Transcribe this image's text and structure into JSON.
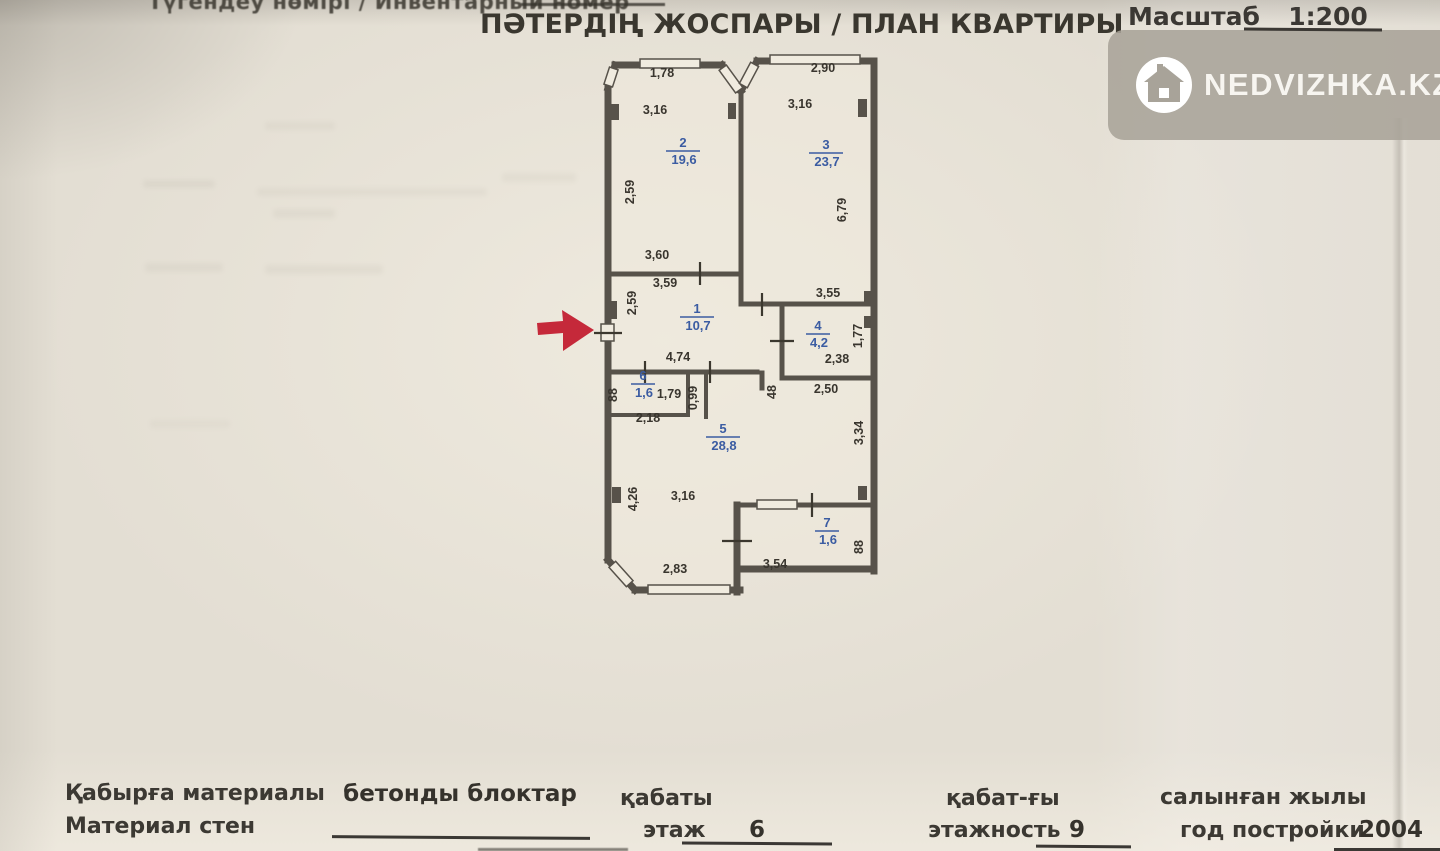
{
  "document": {
    "inventory_label": "Түгендеу нөмірі / Инвентарный номер",
    "title": "ПӘТЕРДІҢ ЖОСПАРЫ / ПЛАН КВАРТИРЫ",
    "scale_label": "Масштаб",
    "scale_value": "1:200"
  },
  "watermark": {
    "brand": "NEDVIZHKA.KZ",
    "icon": "house-icon",
    "badge_color": "#a8a399"
  },
  "plan": {
    "colors": {
      "wall": "#57524a",
      "dimension_text": "#39352e",
      "room_label": "#3b5ca2",
      "arrow": "#c5293a"
    },
    "rooms": [
      {
        "number": "1",
        "area": "10,7",
        "x": 697,
        "y": 317
      },
      {
        "number": "2",
        "area": "19,6",
        "x": 683,
        "y": 151
      },
      {
        "number": "3",
        "area": "23,7",
        "x": 826,
        "y": 153
      },
      {
        "number": "4",
        "area": "4,2",
        "x": 818,
        "y": 334
      },
      {
        "number": "5",
        "area": "28,8",
        "x": 723,
        "y": 437
      },
      {
        "number": "6",
        "area": "1,6",
        "x": 643,
        "y": 384
      },
      {
        "number": "7",
        "area": "1,6",
        "x": 827,
        "y": 531
      }
    ],
    "dimensions": [
      {
        "text": "1,78",
        "x": 662,
        "y": 77,
        "rot": 0
      },
      {
        "text": "2,90",
        "x": 823,
        "y": 72,
        "rot": 0
      },
      {
        "text": "3,16",
        "x": 655,
        "y": 114,
        "rot": 0
      },
      {
        "text": "3,16",
        "x": 800,
        "y": 108,
        "rot": 0
      },
      {
        "text": "2,59",
        "x": 634,
        "y": 192,
        "rot": -90
      },
      {
        "text": "6,79",
        "x": 846,
        "y": 210,
        "rot": -90
      },
      {
        "text": "3,60",
        "x": 657,
        "y": 259,
        "rot": 0
      },
      {
        "text": "3,59",
        "x": 665,
        "y": 287,
        "rot": 0
      },
      {
        "text": "2,59",
        "x": 636,
        "y": 303,
        "rot": -90
      },
      {
        "text": "3,55",
        "x": 828,
        "y": 297,
        "rot": 0
      },
      {
        "text": "1,77",
        "x": 862,
        "y": 336,
        "rot": -90
      },
      {
        "text": "2,38",
        "x": 837,
        "y": 363,
        "rot": 0
      },
      {
        "text": "4,74",
        "x": 678,
        "y": 361,
        "rot": 0
      },
      {
        "text": "1,79",
        "x": 669,
        "y": 398,
        "rot": 0
      },
      {
        "text": "88",
        "x": 617,
        "y": 395,
        "rot": -90
      },
      {
        "text": "0,99",
        "x": 697,
        "y": 398,
        "rot": -90
      },
      {
        "text": "48",
        "x": 776,
        "y": 392,
        "rot": -90
      },
      {
        "text": "2,50",
        "x": 826,
        "y": 393,
        "rot": 0
      },
      {
        "text": "2,18",
        "x": 648,
        "y": 422,
        "rot": 0
      },
      {
        "text": "3,34",
        "x": 863,
        "y": 433,
        "rot": -90
      },
      {
        "text": "4,26",
        "x": 637,
        "y": 499,
        "rot": -90
      },
      {
        "text": "3,16",
        "x": 683,
        "y": 500,
        "rot": 0
      },
      {
        "text": "88",
        "x": 863,
        "y": 547,
        "rot": -90
      },
      {
        "text": "2,83",
        "x": 675,
        "y": 573,
        "rot": 0
      },
      {
        "text": "3,54",
        "x": 775,
        "y": 568,
        "rot": 0
      }
    ]
  },
  "footer": {
    "wall_material": {
      "label_kk": "Қабырға материалы",
      "label_ru": "Материал стен",
      "value": "бетонды блоктар"
    },
    "floor": {
      "label_kk": "қабаты",
      "label_ru": "этаж",
      "value": "6"
    },
    "total_floors": {
      "label_kk": "қабат-ғы",
      "label_ru": "этажность",
      "value": "9"
    },
    "year_built": {
      "label_kk": "салынған жылы",
      "label_ru": "год постройки",
      "value": "2004"
    }
  }
}
